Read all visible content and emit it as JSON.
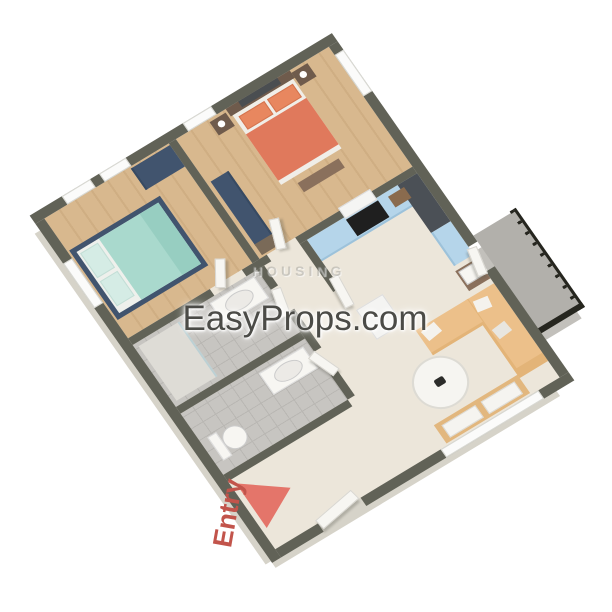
{
  "watermarks": {
    "main": "EasyProps.com",
    "faint": "HOUSING"
  },
  "entry": {
    "label": "Entry"
  },
  "colors": {
    "wall": "#616257",
    "wallFace": "#d6d3c9",
    "cream": "#ece6da",
    "wood": "#d8b88e",
    "woodLine": "#cfae83",
    "tile": "#c7c5c1",
    "tileLine": "#b9b7b3",
    "balconyFloor": "#b2b0ab",
    "navy": "#41546e",
    "coral": "#e0795c",
    "coralPillow": "#e8875f",
    "teal": "#a9d9cd",
    "tealPillow": "#d5ece5",
    "tealThrow": "#97cec1",
    "kitchenBlue": "#b5d5ea",
    "counterDark": "#4b5056",
    "stoveBlack": "#1f1f1f",
    "sofa": "#ecc08a",
    "sofaDark": "#e3b478",
    "woodDark": "#6f5b4c",
    "benchWood": "#8a705c",
    "whiteFurn": "#f7f6f2",
    "railing": "#26261f",
    "watermarkColor": "#4b4b47",
    "housingColor": "rgba(120,120,114,0.32)",
    "entryRed": "#c2544b",
    "arrowSalmon": "#e4756a",
    "sinkBrown": "#8a6b4e",
    "cabinetTan": "#e2b77e"
  }
}
